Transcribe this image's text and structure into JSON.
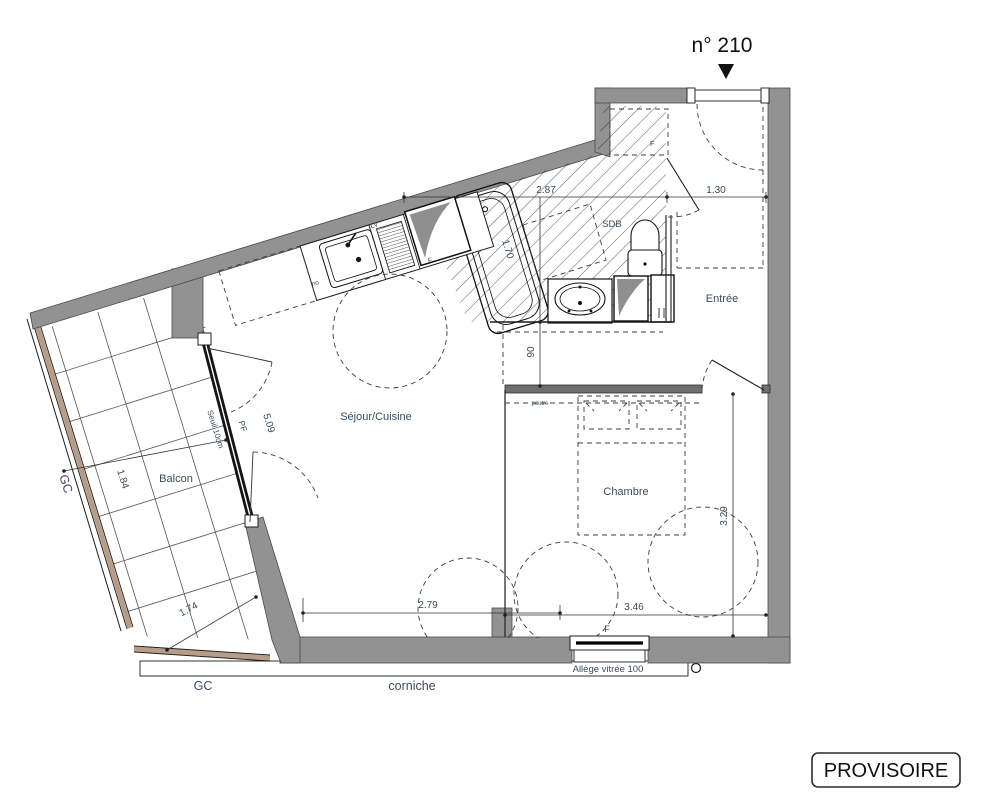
{
  "header": {
    "unit": "n° 210"
  },
  "stamp": {
    "label": "PROVISOIRE"
  },
  "rooms": {
    "sejour": "Séjour/Cuisine",
    "chambre": "Chambre",
    "balcon": "Balcon",
    "entree": "Entrée",
    "sdb": "SDB"
  },
  "dims": {
    "d287": "2.87",
    "d130": "1.30",
    "d90": "90",
    "d509": "5.09",
    "d184": "1.84",
    "d174": "1.74",
    "d279": "2.79",
    "d346": "3.46",
    "d329": "3.29",
    "d170": "1.70"
  },
  "notes": {
    "seuil": "Seuil 10cm",
    "pf": "PF",
    "gc_left": "GC",
    "gc_bottom": "GC",
    "corniche": "corniche",
    "allege": "Allège vitrée 100",
    "poutre": "poutre",
    "lv": "LV",
    "f_fridge": "F",
    "f_window": "F",
    "f_reserve": "F",
    "sink_note": "no"
  },
  "colors": {
    "wall": "#929292",
    "guardrail_wood": "#b79d87",
    "label": "#3b4b5f",
    "line": "#1c1c1c"
  }
}
